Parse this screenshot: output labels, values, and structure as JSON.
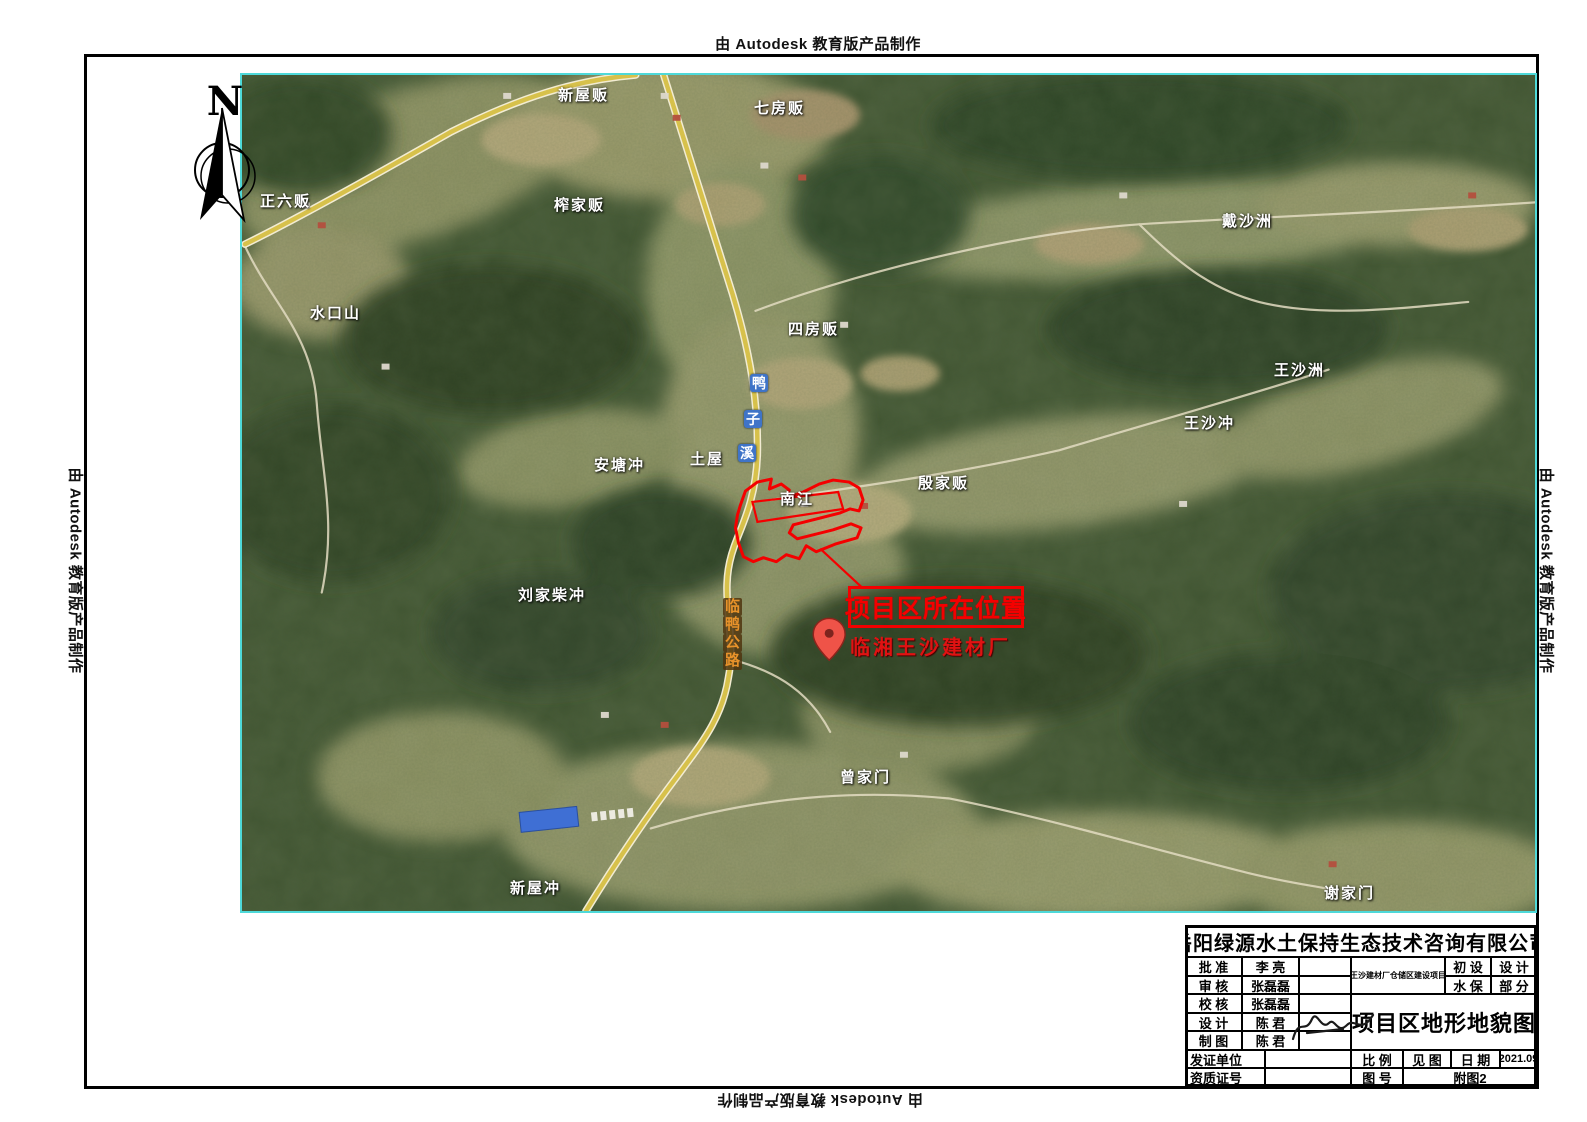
{
  "stamp": {
    "text": "由 Autodesk 教育版产品制作"
  },
  "compass": {
    "north_label": "N"
  },
  "colors": {
    "map_border": "#4ed9d9",
    "highlight_red": "#f40000",
    "road_yellow": "#d7c14b"
  },
  "map": {
    "place_labels": [
      {
        "text": "新屋贩"
      },
      {
        "text": "七房贩"
      },
      {
        "text": "正六贩"
      },
      {
        "text": "榨家贩"
      },
      {
        "text": "水口山"
      },
      {
        "text": "四房贩"
      },
      {
        "text": "戴沙洲"
      },
      {
        "text": "王沙洲"
      },
      {
        "text": "王沙冲"
      },
      {
        "text": "安塘冲"
      },
      {
        "text": "土屋"
      },
      {
        "text": "南江"
      },
      {
        "text": "殷家贩"
      },
      {
        "text": "刘家柴冲"
      },
      {
        "text": "曾家门"
      },
      {
        "text": "新屋冲"
      },
      {
        "text": "谢家门"
      }
    ],
    "stream_chars": {
      "c1": "鸭",
      "c2": "子",
      "c3": "溪"
    },
    "road_chars": {
      "c1": "临",
      "c2": "鸭",
      "c3": "公",
      "c4": "路"
    },
    "callout": {
      "box_text": "项目区所在位置",
      "marker_text": "临湘王沙建材厂"
    }
  },
  "title_block": {
    "company": "岳阳绿源水土保持生态技术咨询有限公司",
    "approve_label": "批 准",
    "approve_name": "李 亮",
    "review_label": "审 核",
    "review_name": "张磊磊",
    "check_label": "校 核",
    "check_name": "张磊磊",
    "design_label": "设 计",
    "design_name": "陈 君",
    "draft_label": "制 图",
    "draft_name": "陈 君",
    "project_name": "王沙建材厂仓储区建设项目",
    "stage_r1c1": "初 设",
    "stage_r1c2": "设 计",
    "stage_r2c1": "水 保",
    "stage_r2c2": "部 分",
    "drawing_title": "项目区地形地貌图",
    "cert_unit_label": "发证单位",
    "cert_no_label": "资质证号",
    "scale_label": "比 例",
    "scale_value": "见 图",
    "date_label": "日 期",
    "date_value": "2021.09",
    "figure_label": "图 号",
    "figure_value": "附图2"
  }
}
